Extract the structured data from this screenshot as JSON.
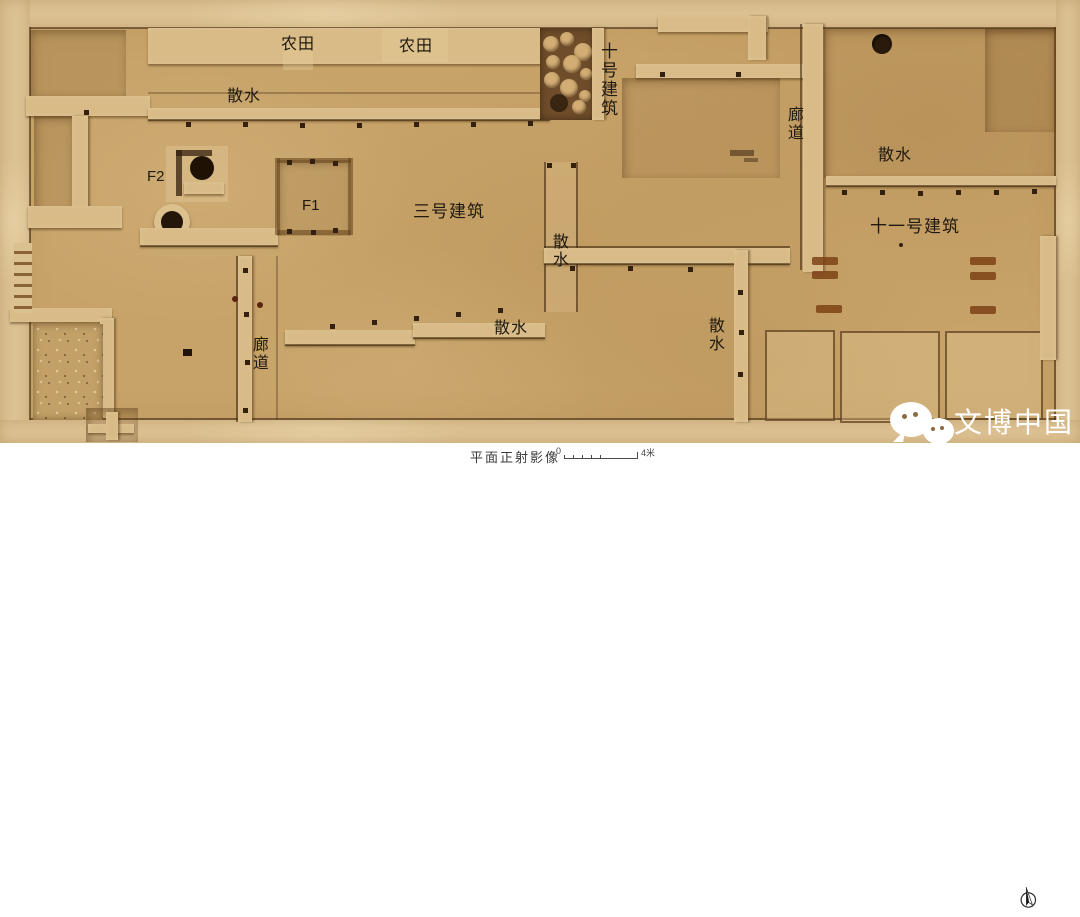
{
  "colors": {
    "ground": "#c7a369",
    "baulk": "#dcc192",
    "wall": "#d8bb87",
    "wall_shadow": "#5e3d1a",
    "label_ink": "#1f1910",
    "pit_dark": "#241507",
    "paper": "#ffffff",
    "watermark_white": "#ffffff"
  },
  "labels": {
    "farmland_1": "农田",
    "farmland_2": "农田",
    "apron_top": "散水",
    "building_10": "十号建筑",
    "corridor_right": "廊道",
    "apron_right": "散水",
    "f2": "F2",
    "f1": "F1",
    "building_3": "三号建筑",
    "apron_mid": "散水",
    "building_11": "十一号建筑",
    "apron_bottom": "散水",
    "apron_bottom_right": "散水",
    "corridor_bottom": "廊道"
  },
  "footer": {
    "caption": "平面正射影像",
    "scale_zero": "0",
    "scale_end": "4米"
  },
  "watermark": {
    "text": "文博中国"
  },
  "icons": {
    "logo": "wechat-speech-bubbles-icon",
    "compass": "north-arrow-icon"
  }
}
